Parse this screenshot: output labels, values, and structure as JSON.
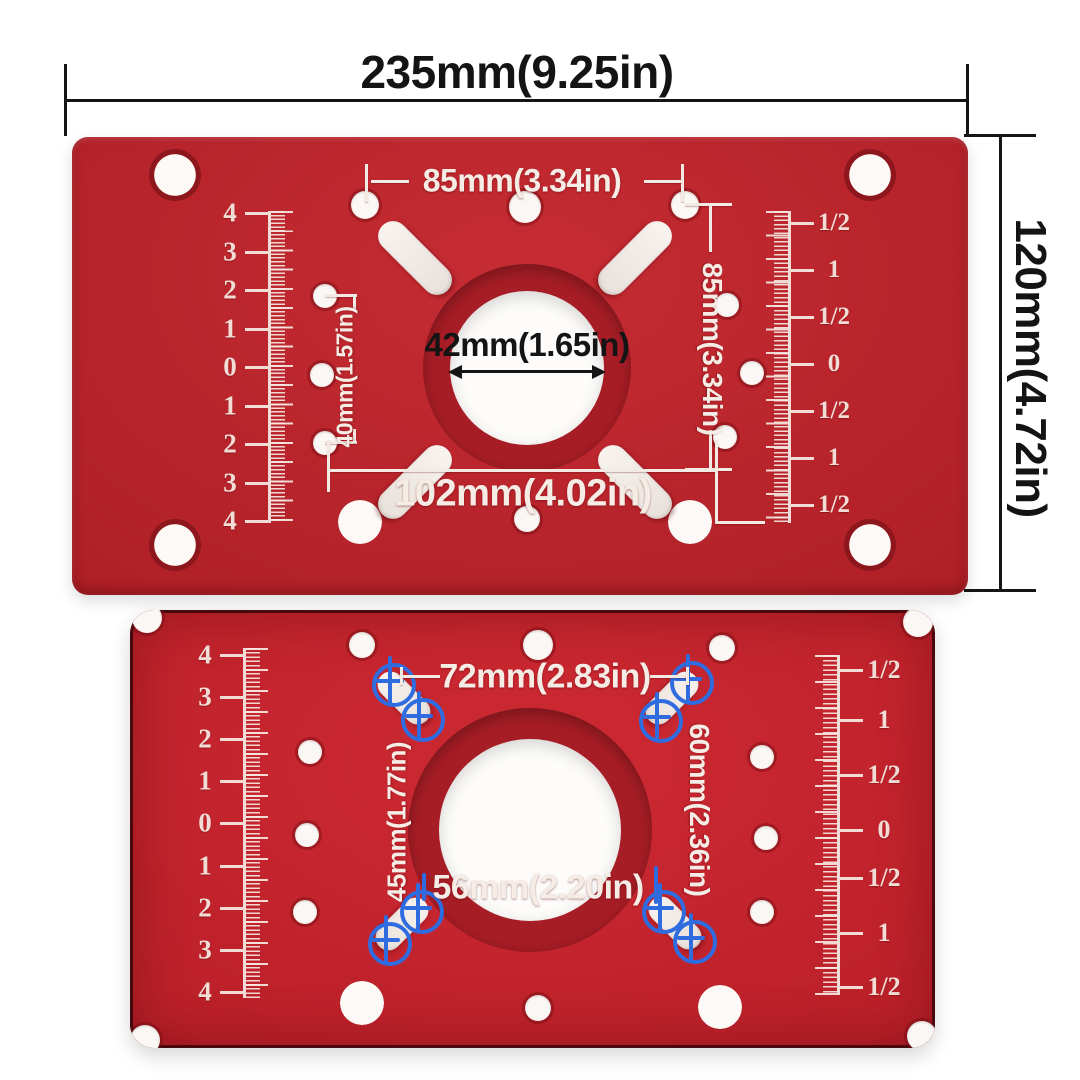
{
  "overall": {
    "width_label": "235mm(9.25in)",
    "height_label": "120mm(4.72in)"
  },
  "plate_top": {
    "top_hole_spacing_label": "85mm(3.34in)",
    "right_hole_spacing_label": "85mm(3.34in)",
    "center_bore_label": "42mm(1.65in)",
    "left_hole_spacing_label": "40mm(1.57in)",
    "bottom_hole_spacing_label": "102mm(4.02in)"
  },
  "plate_bottom": {
    "top_slot_spacing_label": "72mm(2.83in)",
    "right_slot_spacing_label": "60mm(2.36in)",
    "left_slot_spacing_label": "45mm(1.77in)",
    "bottom_slot_spacing_label": "56mm(2.20in)"
  },
  "rulers": {
    "cm_labels": [
      "4",
      "3",
      "2",
      "1",
      "0",
      "1",
      "2",
      "3",
      "4"
    ],
    "inch_labels": [
      "1/2",
      "1",
      "1/2",
      "0",
      "1/2",
      "1",
      "1/2"
    ]
  },
  "colors": {
    "plate_red_top": "#b8222b",
    "plate_red_bottom": "#c0242d",
    "engraving_white": "#f5ece6",
    "dimension_black": "#141414",
    "marker_blue": "#2f6ce0",
    "background": "#ffffff"
  }
}
